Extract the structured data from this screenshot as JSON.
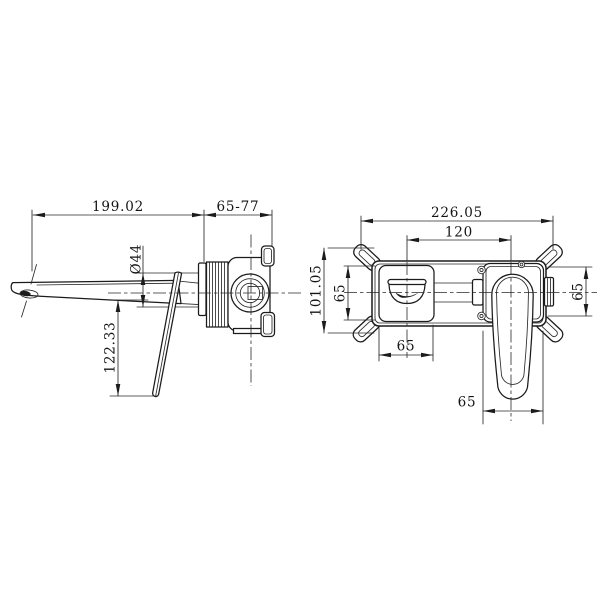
{
  "colors": {
    "background": "#ffffff",
    "line": "#1b1b1b"
  },
  "side_view": {
    "spout_length": "199.02",
    "rough_in_depth_range": "65-77",
    "spout_diameter": "Ø44",
    "handle_drop": "122.33"
  },
  "front_view": {
    "overall_width": "226.05",
    "hole_spacing": "120",
    "overall_height": "101.05",
    "left_box_height": "65",
    "right_box_height": "65",
    "left_box_width": "65",
    "handle_box_width": "65"
  }
}
